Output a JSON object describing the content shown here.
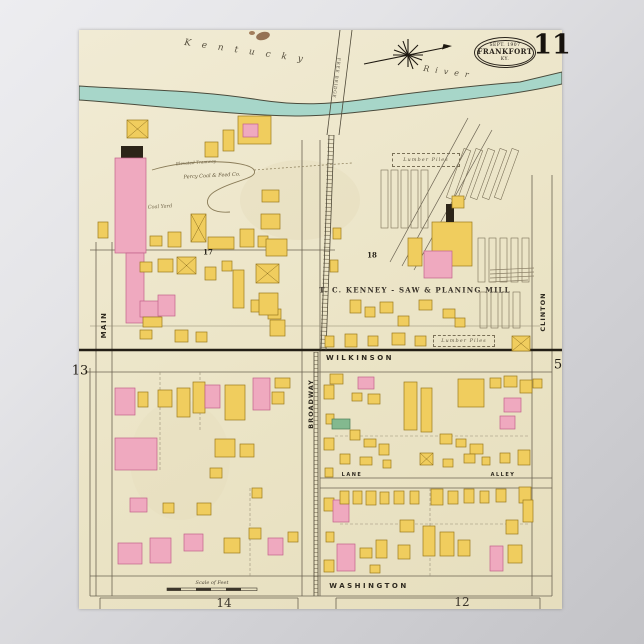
{
  "sheet": {
    "title_stamp": {
      "line1": "SEPT. 1907",
      "line2": "FRANKFORT",
      "line3": "KY."
    },
    "sheet_number": "11",
    "river_name": {
      "word1": "Kentucky",
      "word2": "River"
    },
    "palette": {
      "paper": "#ebe4c6",
      "yellow": "#f0cd5e",
      "yellow_stroke": "#9c7b1d",
      "pink": "#efa9bf",
      "pink_stroke": "#c2638b",
      "green": "#83b98f",
      "green_stroke": "#4c7d59",
      "river": "#a7d6c9",
      "black_detail": "#2c2418"
    },
    "labels": {
      "mill": "T. C. KENNEY - SAW & PLANING MILL",
      "street_wilkinson": "WILKINSON",
      "street_washington": "WASHINGTON",
      "street_main": "MAIN",
      "street_broadway": "BROADWAY",
      "street_clinton": "CLINTON",
      "street_lane": "LANE",
      "street_alley": "ALLEY",
      "coal_company": "Percy Coal & Feed Co.",
      "coal_yard": "Coal Yard",
      "tramway": "Elevated Tramway",
      "lumber_piles_a": "Lumber Piles",
      "lumber_piles_b": "Lumber Piles",
      "free_bridge": "FREE BRIDGE",
      "scale": "Scale of Feet"
    },
    "block_ids": {
      "b17": "17",
      "b18": "18"
    },
    "adjacent_sheets": {
      "left": "13",
      "right": "5",
      "bottom_left": "14",
      "bottom_right": "12"
    }
  },
  "map": {
    "buildings": [
      [
        127,
        120,
        21,
        18,
        "yx"
      ],
      [
        121,
        146,
        22,
        12,
        "k"
      ],
      [
        115,
        158,
        31,
        95,
        "p"
      ],
      [
        126,
        253,
        18,
        70,
        "p"
      ],
      [
        98,
        222,
        10,
        16,
        "y"
      ],
      [
        205,
        142,
        13,
        15,
        "y"
      ],
      [
        191,
        214,
        15,
        28,
        "yx"
      ],
      [
        208,
        237,
        26,
        12,
        "y"
      ],
      [
        150,
        236,
        12,
        10,
        "y"
      ],
      [
        168,
        232,
        13,
        15,
        "y"
      ],
      [
        240,
        229,
        14,
        18,
        "y"
      ],
      [
        258,
        236,
        10,
        11,
        "y"
      ],
      [
        238,
        116,
        33,
        28,
        "y"
      ],
      [
        243,
        124,
        15,
        13,
        "p"
      ],
      [
        223,
        130,
        11,
        21,
        "y"
      ],
      [
        140,
        262,
        12,
        10,
        "y"
      ],
      [
        158,
        259,
        15,
        13,
        "y"
      ],
      [
        177,
        257,
        19,
        17,
        "yx"
      ],
      [
        205,
        267,
        11,
        13,
        "y"
      ],
      [
        222,
        261,
        10,
        10,
        "y"
      ],
      [
        140,
        301,
        21,
        16,
        "p"
      ],
      [
        158,
        295,
        17,
        21,
        "p"
      ],
      [
        143,
        317,
        19,
        10,
        "y"
      ],
      [
        251,
        300,
        12,
        12,
        "y"
      ],
      [
        268,
        309,
        13,
        10,
        "y"
      ],
      [
        233,
        270,
        11,
        38,
        "y"
      ],
      [
        262,
        190,
        17,
        12,
        "y"
      ],
      [
        261,
        214,
        19,
        15,
        "y"
      ],
      [
        266,
        239,
        21,
        17,
        "y"
      ],
      [
        256,
        264,
        23,
        19,
        "yx"
      ],
      [
        259,
        293,
        19,
        22,
        "y"
      ],
      [
        270,
        320,
        15,
        16,
        "y"
      ],
      [
        175,
        330,
        13,
        12,
        "y"
      ],
      [
        196,
        332,
        11,
        10,
        "y"
      ],
      [
        140,
        330,
        12,
        9,
        "y"
      ],
      [
        345,
        334,
        12,
        13,
        "y"
      ],
      [
        368,
        336,
        10,
        10,
        "y"
      ],
      [
        392,
        333,
        13,
        12,
        "y"
      ],
      [
        415,
        336,
        11,
        10,
        "y"
      ],
      [
        512,
        336,
        18,
        15,
        "yx"
      ],
      [
        325,
        336,
        9,
        11,
        "y"
      ],
      [
        350,
        300,
        11,
        13,
        "y"
      ],
      [
        365,
        307,
        10,
        10,
        "y"
      ],
      [
        380,
        302,
        13,
        11,
        "y"
      ],
      [
        398,
        316,
        11,
        10,
        "y"
      ],
      [
        455,
        318,
        10,
        9,
        "y"
      ],
      [
        333,
        228,
        8,
        11,
        "y"
      ],
      [
        330,
        260,
        8,
        12,
        "y"
      ],
      [
        432,
        222,
        40,
        44,
        "y"
      ],
      [
        424,
        251,
        28,
        27,
        "p"
      ],
      [
        446,
        204,
        8,
        18,
        "k"
      ],
      [
        408,
        238,
        14,
        28,
        "y"
      ],
      [
        452,
        196,
        12,
        12,
        "y"
      ],
      [
        419,
        300,
        13,
        10,
        "y"
      ],
      [
        443,
        309,
        12,
        9,
        "y"
      ],
      [
        115,
        388,
        20,
        27,
        "p"
      ],
      [
        138,
        392,
        10,
        15,
        "y"
      ],
      [
        158,
        390,
        14,
        17,
        "y"
      ],
      [
        177,
        388,
        13,
        29,
        "y"
      ],
      [
        193,
        382,
        12,
        31,
        "y"
      ],
      [
        205,
        385,
        15,
        23,
        "p"
      ],
      [
        225,
        385,
        20,
        35,
        "y"
      ],
      [
        253,
        378,
        17,
        32,
        "p"
      ],
      [
        275,
        378,
        15,
        10,
        "y"
      ],
      [
        272,
        392,
        12,
        12,
        "y"
      ],
      [
        115,
        438,
        42,
        32,
        "p"
      ],
      [
        215,
        439,
        20,
        18,
        "y"
      ],
      [
        240,
        444,
        14,
        13,
        "y"
      ],
      [
        130,
        498,
        17,
        14,
        "p"
      ],
      [
        163,
        503,
        11,
        10,
        "y"
      ],
      [
        197,
        503,
        14,
        12,
        "y"
      ],
      [
        252,
        488,
        10,
        10,
        "y"
      ],
      [
        210,
        468,
        12,
        10,
        "y"
      ],
      [
        118,
        543,
        24,
        21,
        "p"
      ],
      [
        150,
        538,
        21,
        25,
        "p"
      ],
      [
        184,
        534,
        19,
        17,
        "p"
      ],
      [
        224,
        538,
        16,
        15,
        "y"
      ],
      [
        249,
        528,
        12,
        11,
        "y"
      ],
      [
        268,
        538,
        15,
        17,
        "p"
      ],
      [
        288,
        532,
        10,
        10,
        "y"
      ],
      [
        324,
        385,
        10,
        14,
        "y"
      ],
      [
        326,
        414,
        8,
        10,
        "y"
      ],
      [
        324,
        438,
        10,
        12,
        "y"
      ],
      [
        325,
        468,
        8,
        9,
        "y"
      ],
      [
        324,
        498,
        10,
        13,
        "y"
      ],
      [
        326,
        532,
        8,
        10,
        "y"
      ],
      [
        324,
        560,
        10,
        12,
        "y"
      ],
      [
        330,
        374,
        13,
        10,
        "y"
      ],
      [
        358,
        377,
        16,
        12,
        "p"
      ],
      [
        352,
        393,
        10,
        8,
        "y"
      ],
      [
        368,
        394,
        12,
        10,
        "y"
      ],
      [
        332,
        419,
        18,
        10,
        "g"
      ],
      [
        404,
        382,
        13,
        48,
        "y"
      ],
      [
        421,
        388,
        11,
        44,
        "y"
      ],
      [
        458,
        379,
        26,
        28,
        "y"
      ],
      [
        490,
        378,
        11,
        10,
        "y"
      ],
      [
        504,
        376,
        13,
        11,
        "y"
      ],
      [
        520,
        380,
        12,
        13,
        "y"
      ],
      [
        533,
        379,
        9,
        9,
        "y"
      ],
      [
        504,
        398,
        17,
        14,
        "p"
      ],
      [
        500,
        416,
        15,
        13,
        "p"
      ],
      [
        350,
        430,
        10,
        10,
        "y"
      ],
      [
        364,
        439,
        12,
        8,
        "y"
      ],
      [
        379,
        444,
        10,
        11,
        "y"
      ],
      [
        440,
        434,
        12,
        10,
        "y"
      ],
      [
        456,
        439,
        10,
        8,
        "y"
      ],
      [
        470,
        444,
        13,
        10,
        "y"
      ],
      [
        340,
        454,
        10,
        10,
        "y"
      ],
      [
        360,
        457,
        12,
        8,
        "y"
      ],
      [
        383,
        460,
        8,
        8,
        "y"
      ],
      [
        420,
        453,
        13,
        12,
        "yx"
      ],
      [
        443,
        459,
        10,
        8,
        "y"
      ],
      [
        464,
        454,
        11,
        9,
        "y"
      ],
      [
        482,
        457,
        8,
        8,
        "y"
      ],
      [
        500,
        453,
        10,
        10,
        "y"
      ],
      [
        518,
        450,
        12,
        15,
        "y"
      ],
      [
        333,
        500,
        16,
        22,
        "p"
      ],
      [
        340,
        491,
        9,
        13,
        "y"
      ],
      [
        353,
        491,
        9,
        13,
        "y"
      ],
      [
        366,
        491,
        10,
        14,
        "y"
      ],
      [
        380,
        492,
        9,
        12,
        "y"
      ],
      [
        394,
        491,
        10,
        13,
        "y"
      ],
      [
        410,
        491,
        9,
        13,
        "y"
      ],
      [
        431,
        489,
        12,
        16,
        "y"
      ],
      [
        448,
        491,
        10,
        13,
        "y"
      ],
      [
        464,
        489,
        10,
        14,
        "y"
      ],
      [
        480,
        491,
        9,
        12,
        "y"
      ],
      [
        496,
        489,
        10,
        13,
        "y"
      ],
      [
        519,
        487,
        12,
        16,
        "y"
      ],
      [
        337,
        544,
        18,
        27,
        "p"
      ],
      [
        360,
        548,
        12,
        10,
        "y"
      ],
      [
        376,
        540,
        11,
        18,
        "y"
      ],
      [
        400,
        520,
        14,
        12,
        "y"
      ],
      [
        423,
        526,
        12,
        30,
        "y"
      ],
      [
        440,
        532,
        14,
        24,
        "y"
      ],
      [
        458,
        540,
        12,
        16,
        "y"
      ],
      [
        490,
        546,
        13,
        25,
        "p"
      ],
      [
        506,
        520,
        12,
        14,
        "y"
      ],
      [
        508,
        545,
        14,
        18,
        "y"
      ],
      [
        523,
        500,
        10,
        22,
        "y"
      ],
      [
        398,
        545,
        12,
        14,
        "y"
      ],
      [
        370,
        565,
        10,
        8,
        "y"
      ]
    ],
    "lumber_piles": [
      [
        381,
        170,
        7,
        58,
        0
      ],
      [
        391,
        170,
        7,
        58,
        0
      ],
      [
        401,
        170,
        7,
        58,
        0
      ],
      [
        411,
        170,
        7,
        58,
        0
      ],
      [
        421,
        170,
        7,
        58,
        0
      ],
      [
        455,
        148,
        7,
        52,
        20
      ],
      [
        467,
        148,
        7,
        52,
        20
      ],
      [
        479,
        148,
        7,
        52,
        20
      ],
      [
        491,
        148,
        7,
        52,
        20
      ],
      [
        503,
        148,
        7,
        52,
        20
      ],
      [
        478,
        238,
        7,
        44,
        0
      ],
      [
        489,
        238,
        7,
        44,
        0
      ],
      [
        500,
        238,
        7,
        44,
        0
      ],
      [
        511,
        238,
        7,
        44,
        0
      ],
      [
        522,
        238,
        7,
        44,
        0
      ],
      [
        480,
        292,
        7,
        36,
        0
      ],
      [
        491,
        292,
        7,
        36,
        0
      ],
      [
        502,
        292,
        7,
        36,
        0
      ],
      [
        513,
        292,
        7,
        36,
        0
      ]
    ]
  }
}
